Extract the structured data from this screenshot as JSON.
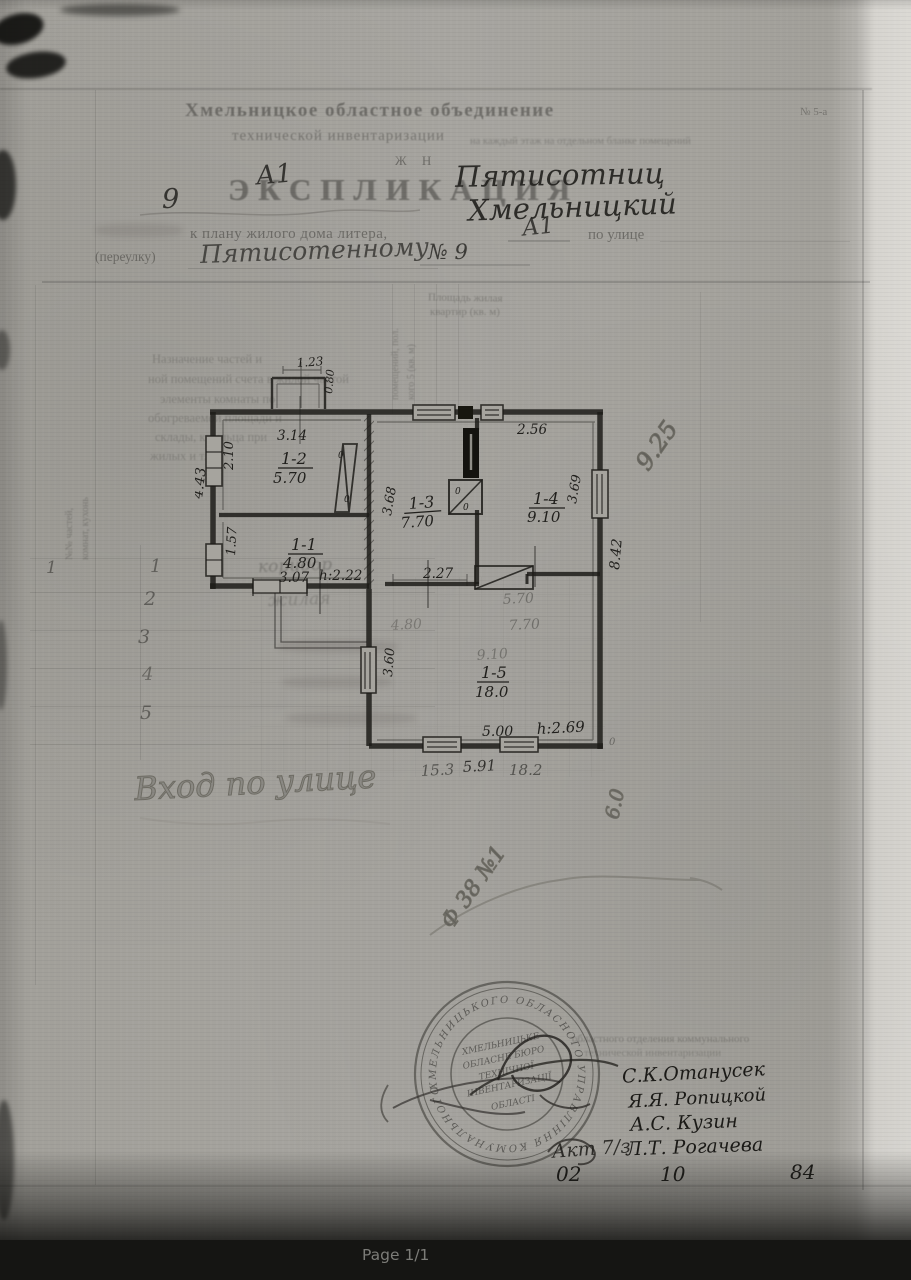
{
  "page": {
    "footer_label": "Page 1/1"
  },
  "header": {
    "org_line1": "Хмельницкое областное объединение",
    "org_line2": "технической инвентаризации",
    "form_ref": "№ 5-а",
    "small_note": "на каждый этаж на отдельном бланке помещений",
    "code": "Ж Н",
    "title": "ЭКСПЛИКАЦИЯ",
    "hw_litera_top": "А1",
    "hw_number_left": "9",
    "hw_name_line1": "Пятисотниц",
    "hw_name_line2": "Хмельницкий",
    "plan_line": "к плану жилого дома литера,",
    "hw_litera": "А1",
    "street_label": "по улице",
    "lane_label": "(переулку)",
    "hw_street": "Пятисотенному",
    "hw_house": "№ 9"
  },
  "form": {
    "col_area1": "Площадь жилая",
    "col_area2": "квартир (кв. м)",
    "rot_col1": "помещений, пол.",
    "rot_col2": "кого 5 (кв. м)",
    "rot_left1": "№№ частей,",
    "rot_left2": "комнат, кухонь",
    "faint_lines": [
      "Назначение частей и",
      "ной помещений счета в жилой частой",
      "элементы комнаты по",
      "обогреваемой площади и",
      "склады, крыльца при",
      "жилых и т. п."
    ],
    "first_col": "1",
    "rows": [
      {
        "no": "1",
        "name": "коридор"
      },
      {
        "no": "2",
        "name": "жилая"
      },
      {
        "no": "3",
        "name": ""
      },
      {
        "no": "4",
        "name": ""
      },
      {
        "no": "5",
        "name": ""
      }
    ]
  },
  "plan": {
    "rooms": {
      "r12": {
        "id": "1-2",
        "area": "5.70",
        "dim_top": "3.14",
        "dim_side": "2.10"
      },
      "r11": {
        "id": "1-1",
        "area": "4.80",
        "dim_bottom": "3.07",
        "dim_side": "1.57",
        "height": "h:2.22"
      },
      "r13": {
        "id": "1-3",
        "area": "7.70",
        "dim_side": "3.68",
        "dim_bottom": "2.27"
      },
      "r14": {
        "id": "1-4",
        "area": "9.10",
        "dim_top": "2.56",
        "dim_side": "3.69"
      },
      "r15": {
        "id": "1-5",
        "area": "18.0",
        "dim_bottom": "5.00",
        "dim_side": "3.60",
        "height": "h:2.69"
      }
    },
    "outer": {
      "left": "4.43",
      "right": "8.42",
      "porch_top": "1.23",
      "porch_side": "0.80"
    },
    "below": {
      "d1": "15.3",
      "d2": "5.91",
      "d3": "18.2"
    },
    "erased": {
      "e1": "5.70",
      "e2": "7.70",
      "e3": "9.10",
      "e4": "4.80"
    },
    "door_zero": "0"
  },
  "pencil": {
    "diag_area": "9.25",
    "f38": "Ф 38 №1",
    "six": "6.0",
    "bottom_note": "Вход  по  улице"
  },
  "stamp": {
    "ring": "ХМЕЛЬНИЦЬКОГО ОБЛАСНОГО УПРАВЛІННЯ КОМУНАЛЬНОГО ГОСПОДАРСТВА • ",
    "inner": {
      "l1": "ХМЕЛЬНИЦЬКЕ",
      "l2": "ОБЛАСНЕ БЮРО",
      "l3": "ТЕХНІЧНОЇ",
      "l4": "ІНВЕНТАРИЗАЦІЇ",
      "l5": "ОБЛАСТІ"
    }
  },
  "signatures": {
    "faint_line1": "областного отделения коммунального",
    "faint_line2": "технической инвентаризации",
    "names": {
      "n1": "С.К.Отанусек",
      "n2": "Я.Я. Ропицкой",
      "n3": "А.С. Кузин",
      "n4": "Л.Т. Рогачева"
    },
    "note": "Акт 7/з",
    "date": {
      "d": "02",
      "m": "10",
      "y": "84"
    }
  }
}
